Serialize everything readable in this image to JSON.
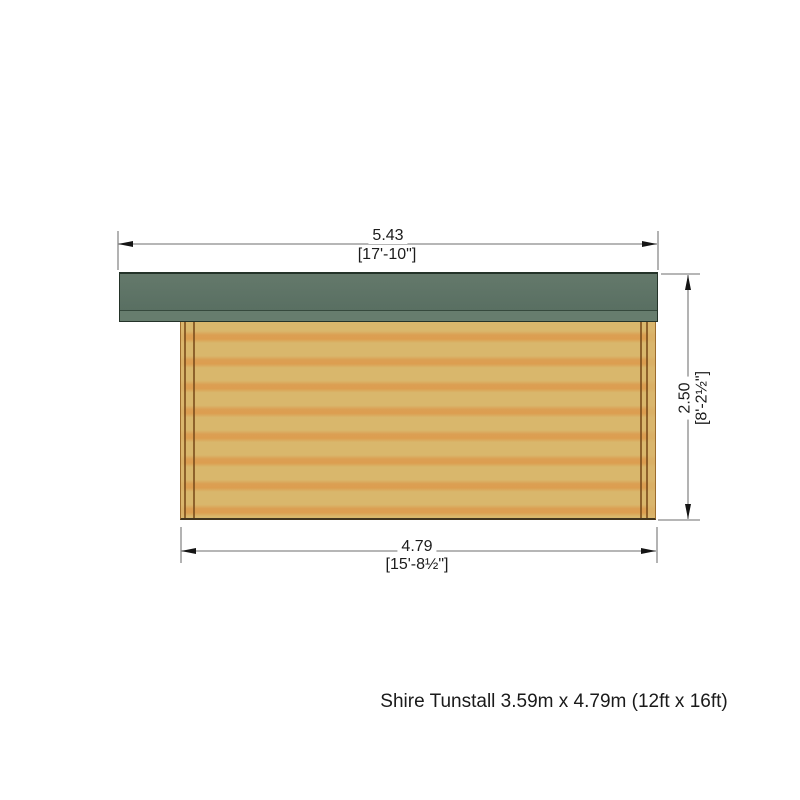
{
  "diagram": {
    "type": "elevation-drawing",
    "caption": "Shire Tunstall 3.59m x 4.79m (12ft x 16ft)",
    "dimensions": {
      "top": {
        "metric": "5.43",
        "imperial": "[17'-10\"]"
      },
      "right": {
        "metric": "2.50",
        "imperial": "[8'-2½\"]"
      },
      "bottom": {
        "metric": "4.79",
        "imperial": "[15'-8½\"]"
      }
    },
    "colors": {
      "roof_main": "#5f7566",
      "roof_fascia": "#677d6e",
      "roof_outline": "#243329",
      "wall_log_light": "#d9b76c",
      "wall_log_dark": "#dc9e50",
      "corner_post_seam": "#7b4c1c",
      "dimension_line": "#8a8a8a",
      "text": "#1c1c1c",
      "background": "#ffffff"
    }
  }
}
